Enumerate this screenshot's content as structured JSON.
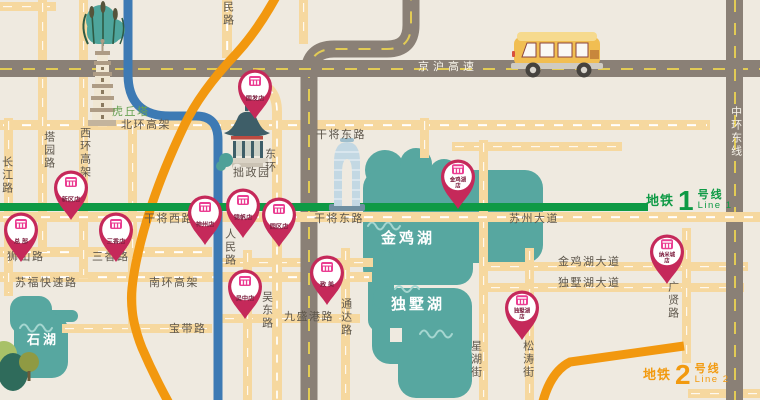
{
  "colors": {
    "background": "#EFEAE0",
    "road_tan": "#F6D89F",
    "road_gray": "#8A8076",
    "canal_blue": "#3D7AB4",
    "lake_teal": "#57A7A0",
    "line1_green": "#0E9A45",
    "line2_orange": "#F2980F",
    "pin_red": "#C5295A",
    "pin_logo_pink": "#EB3D92"
  },
  "metro_lines": [
    {
      "prefix": "地铁",
      "number": "1",
      "suffix": "号线",
      "latin": "Line 1"
    },
    {
      "prefix": "地铁",
      "number": "2",
      "suffix": "号线",
      "latin": "Line 2"
    }
  ],
  "labels": [
    {
      "text": "京沪高速",
      "x": 418,
      "y": 61,
      "cls": "white sp"
    },
    {
      "text": "中环东线",
      "x": 729,
      "y": 106,
      "cls": "white v"
    },
    {
      "text": "北环高架",
      "x": 121,
      "y": 119,
      "cls": ""
    },
    {
      "text": "西环高架",
      "x": 78,
      "y": 127,
      "cls": "v"
    },
    {
      "text": "塔园路",
      "x": 42,
      "y": 131,
      "cls": "v"
    },
    {
      "text": "长江路",
      "x": 0,
      "y": 156,
      "cls": "v"
    },
    {
      "text": "民路",
      "x": 221,
      "y": 1,
      "cls": "v"
    },
    {
      "text": "东环",
      "x": 263,
      "y": 148,
      "cls": "v"
    },
    {
      "text": "干将东路",
      "x": 316,
      "y": 129,
      "cls": ""
    },
    {
      "text": "干将西路",
      "x": 144,
      "y": 213,
      "cls": ""
    },
    {
      "text": "干将东路",
      "x": 314,
      "y": 213,
      "cls": ""
    },
    {
      "text": "苏州大道",
      "x": 509,
      "y": 213,
      "cls": ""
    },
    {
      "text": "人民路",
      "x": 223,
      "y": 228,
      "cls": "v"
    },
    {
      "text": "狮山路",
      "x": 7,
      "y": 251,
      "cls": ""
    },
    {
      "text": "三香路",
      "x": 92,
      "y": 251,
      "cls": ""
    },
    {
      "text": "苏福快速路",
      "x": 15,
      "y": 277,
      "cls": ""
    },
    {
      "text": "南环高架",
      "x": 149,
      "y": 277,
      "cls": ""
    },
    {
      "text": "宝带路",
      "x": 169,
      "y": 323,
      "cls": ""
    },
    {
      "text": "吴东路",
      "x": 260,
      "y": 291,
      "cls": "v"
    },
    {
      "text": "九盛港路",
      "x": 284,
      "y": 311,
      "cls": ""
    },
    {
      "text": "通达路",
      "x": 339,
      "y": 298,
      "cls": "v"
    },
    {
      "text": "金鸡湖大道",
      "x": 558,
      "y": 256,
      "cls": ""
    },
    {
      "text": "独墅湖大道",
      "x": 558,
      "y": 277,
      "cls": ""
    },
    {
      "text": "广贤路",
      "x": 666,
      "y": 281,
      "cls": "v"
    },
    {
      "text": "星湖街",
      "x": 469,
      "y": 340,
      "cls": "v"
    },
    {
      "text": "松涛街",
      "x": 521,
      "y": 340,
      "cls": "v"
    },
    {
      "text": "虎丘塔",
      "x": 112,
      "y": 106,
      "cls": "green"
    },
    {
      "text": "拙政园",
      "x": 233,
      "y": 167,
      "cls": ""
    },
    {
      "text": "金鸡湖",
      "x": 381,
      "y": 230,
      "cls": "lake"
    },
    {
      "text": "独墅湖",
      "x": 391,
      "y": 296,
      "cls": "lake"
    },
    {
      "text": "石湖",
      "x": 27,
      "y": 333,
      "cls": "lake sm"
    }
  ],
  "pins": [
    {
      "x": 255,
      "y": 86,
      "lines": [
        "国发店"
      ]
    },
    {
      "x": 71,
      "y": 187,
      "lines": [
        "新区店"
      ]
    },
    {
      "x": 21,
      "y": 229,
      "lines": [
        "总 部"
      ]
    },
    {
      "x": 116,
      "y": 229,
      "lines": [
        "三香店"
      ]
    },
    {
      "x": 205,
      "y": 212,
      "lines": [
        "神州店"
      ]
    },
    {
      "x": 243,
      "y": 205,
      "lines": [
        "锦帆店"
      ]
    },
    {
      "x": 279,
      "y": 214,
      "lines": [
        "园区店"
      ]
    },
    {
      "x": 245,
      "y": 286,
      "lines": [
        "吴中店"
      ]
    },
    {
      "x": 327,
      "y": 272,
      "lines": [
        "致 美"
      ]
    },
    {
      "x": 458,
      "y": 176,
      "lines": [
        "金鸡湖",
        "店"
      ]
    },
    {
      "x": 667,
      "y": 251,
      "lines": [
        "纳米城",
        "店"
      ]
    },
    {
      "x": 522,
      "y": 307,
      "lines": [
        "独墅湖",
        "店"
      ]
    }
  ]
}
